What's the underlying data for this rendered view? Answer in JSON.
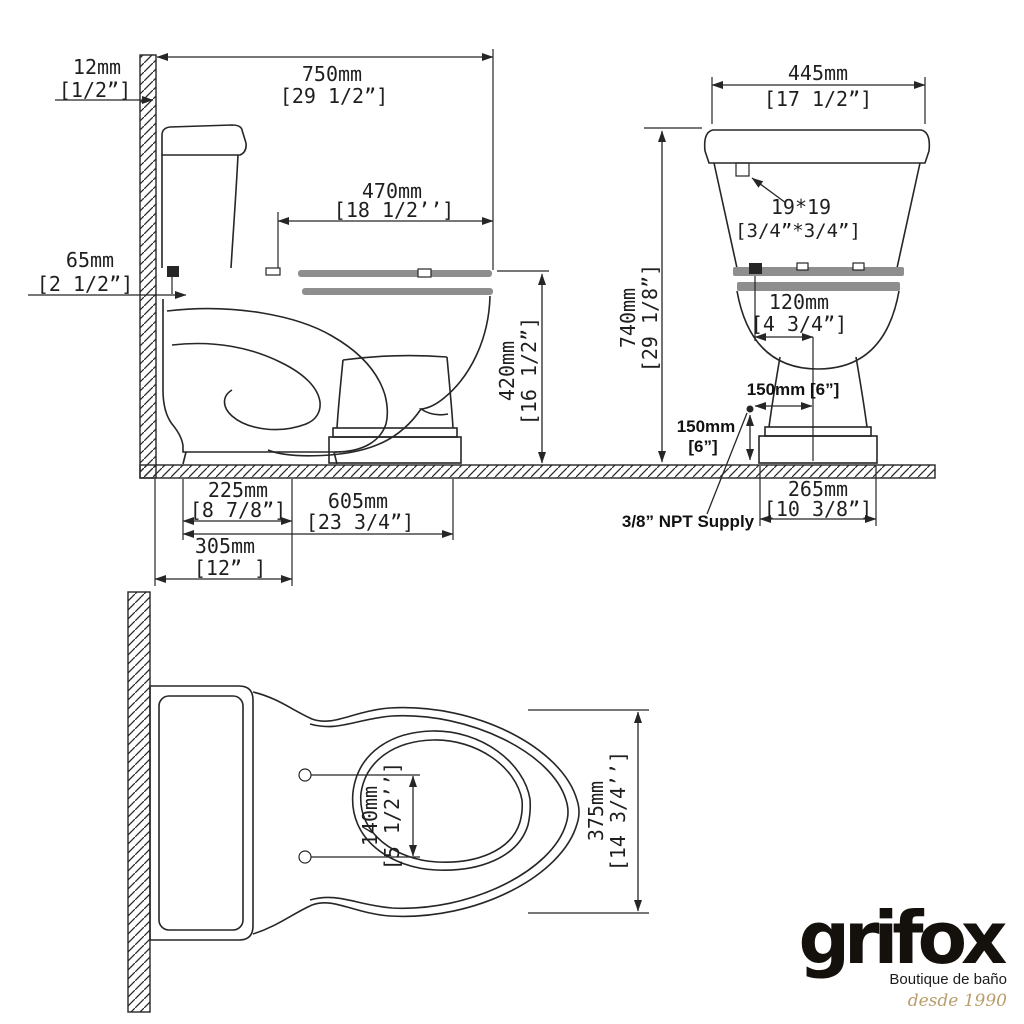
{
  "drawing_type": "toilet-technical-dimension-drawing",
  "colors": {
    "line": "#262626",
    "seat_gray": "#8e8e8e",
    "logo_gold": "#b99e6c",
    "background": "#ffffff"
  },
  "side": {
    "wall_thickness_mm": "12mm",
    "wall_thickness_in": "[1/2”]",
    "depth_mm": "750mm",
    "depth_in": "[29 1/2”]",
    "seat_length_mm": "470mm",
    "seat_length_in": "[18 1/2’’]",
    "supply_height_mm": "65mm",
    "supply_height_in": "[2 1/2”]",
    "rim_height_mm": "420mm",
    "rim_height_in": "[16 1/2”]",
    "outlet_offset_mm": "225mm",
    "outlet_offset_in": "[8 7/8”]",
    "base_length_mm": "605mm",
    "base_length_in": "[23 3/4”]",
    "rough_in_mm": "305mm",
    "rough_in_in": "[12” ]"
  },
  "front": {
    "tank_width_mm": "445mm",
    "tank_width_in": "[17 1/2”]",
    "height_mm": "740mm",
    "height_in": "[29 1/8”]",
    "hole_size": "19*19",
    "hole_size_in": "[3/4”*3/4”]",
    "hole_offset_mm": "120mm",
    "hole_offset_in": "[4 3/4”]",
    "supply_offset_x": "150mm [6”]",
    "supply_offset_y_mm": "150mm",
    "supply_offset_y_in": "[6”]",
    "supply_label": "3/8” NPT Supply",
    "base_width_mm": "265mm",
    "base_width_in": "[10 3/8”]"
  },
  "plan": {
    "bolt_spacing_mm": "140mm",
    "bolt_spacing_in": "[5 1/2’’]",
    "bowl_width_mm": "375mm",
    "bowl_width_in": "[14 3/4’’]"
  },
  "logo": {
    "brand": "grifox",
    "tagline": "Boutique de baño",
    "since": "desde 1990"
  }
}
